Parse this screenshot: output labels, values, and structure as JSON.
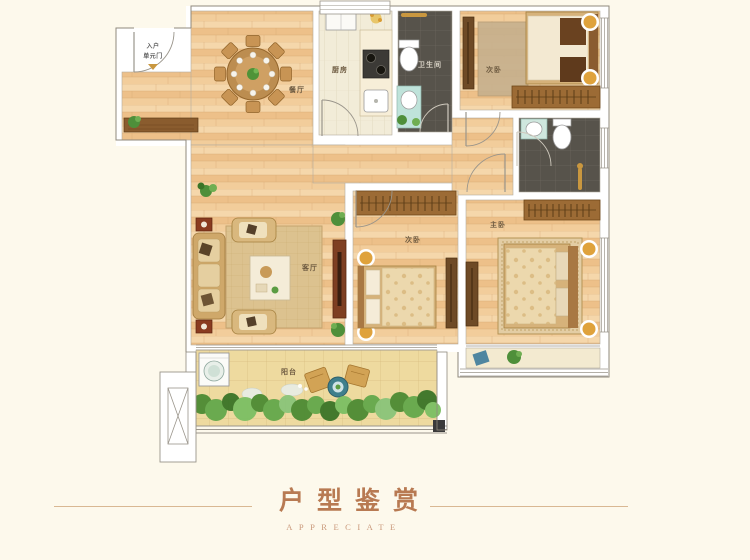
{
  "title": {
    "main": "户型鉴赏",
    "sub": "APPRECIATE"
  },
  "entrance": {
    "line1": "入户",
    "line2": "单元门"
  },
  "rooms": {
    "dining": {
      "label": "餐厅"
    },
    "kitchen": {
      "label": "厨房"
    },
    "bathroom": {
      "label": "卫生间"
    },
    "bedroom_top": {
      "label": "次卧"
    },
    "bedroom_mid": {
      "label": "次卧"
    },
    "master": {
      "label": "主卧"
    },
    "living": {
      "label": "客厅"
    },
    "balcony": {
      "label": "阳台"
    }
  },
  "colors": {
    "background": "#fdf9ec",
    "accent_title": "#b87a52",
    "divider_line": "#d9b893",
    "wood_floor": "#f2cd9b",
    "wall": "#ffffff",
    "dark_tile": "#57534b",
    "kitchen_tile": "#f2ecd8",
    "balcony_tile": "#eeda9f",
    "plant_green": "#5b9c42",
    "gold_fixture": "#d99c2e"
  }
}
